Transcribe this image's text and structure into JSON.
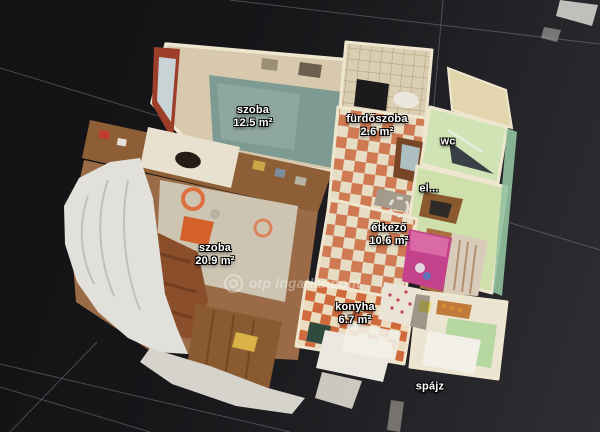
{
  "scene": {
    "view": "3D dollhouse floor plan",
    "background_top_left": "#131315",
    "background_bottom_right": "#2e2e33",
    "grid_line_color": "#8a8a92"
  },
  "rooms": [
    {
      "name": "szoba",
      "area": "12.5 m²"
    },
    {
      "name": "fürdőszoba",
      "area": "2.6 m²"
    },
    {
      "name": "wc",
      "area": ""
    },
    {
      "name": "el...",
      "area": ""
    },
    {
      "name": "étkező",
      "area": "10.6 m²"
    },
    {
      "name": "szoba",
      "area": "20.9 m²"
    },
    {
      "name": "konyha",
      "area": "6.7 m²"
    },
    {
      "name": "spájz",
      "area": ""
    }
  ],
  "watermark": {
    "text": "otp ingatlanpont",
    "color": "#ffffff"
  },
  "label_style": {
    "text_color": "#ffffff",
    "outline_color": "#000000"
  }
}
